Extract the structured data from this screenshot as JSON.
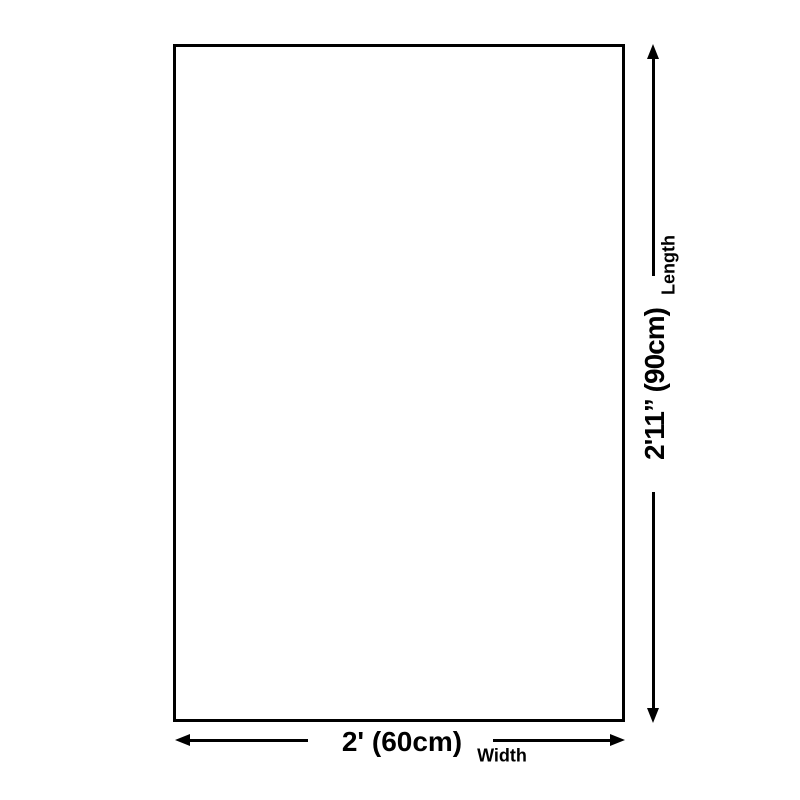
{
  "diagram": {
    "background_color": "#ffffff",
    "stroke_color": "#000000",
    "shape": "rectangle",
    "length_dimension": {
      "value": "2'11” (90cm)",
      "label": "Length"
    },
    "width_dimension": {
      "value": "2' (60cm)",
      "label": "Width"
    }
  }
}
